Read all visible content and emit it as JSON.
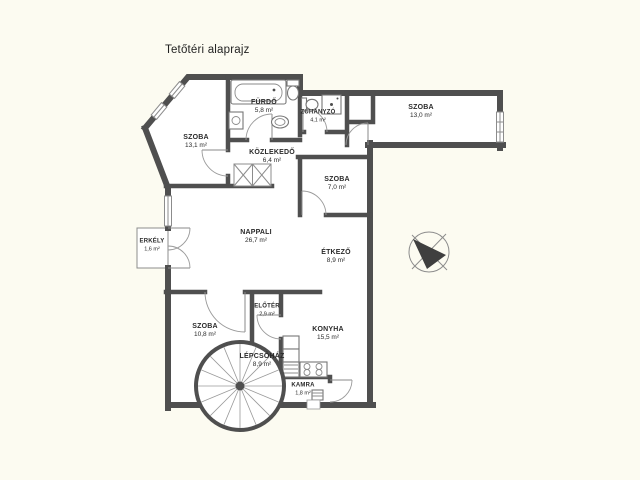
{
  "title": "Tetőtéri alaprajz",
  "rooms": [
    {
      "id": "szoba-131",
      "name": "SZOBA",
      "area": "13,1 m²"
    },
    {
      "id": "furdo",
      "name": "FÜRDŐ",
      "area": "5,8 m²"
    },
    {
      "id": "zuhanyzo",
      "name": "ZUHANYZÓ",
      "area": "4,1 m²"
    },
    {
      "id": "szoba-130",
      "name": "SZOBA",
      "area": "13,0 m²"
    },
    {
      "id": "kozlekedo",
      "name": "KÖZLEKEDŐ",
      "area": "6,4 m²"
    },
    {
      "id": "szoba-70",
      "name": "SZOBA",
      "area": "7,0 m²"
    },
    {
      "id": "erkely",
      "name": "ERKÉLY",
      "area": "1,6 m²"
    },
    {
      "id": "nappali",
      "name": "NAPPALI",
      "area": "26,7 m²"
    },
    {
      "id": "etkezo",
      "name": "ÉTKEZŐ",
      "area": "8,9 m²"
    },
    {
      "id": "szoba-108",
      "name": "SZOBA",
      "area": "10,8 m²"
    },
    {
      "id": "eloter",
      "name": "ELŐTÉR",
      "area": "2,9 m²"
    },
    {
      "id": "lepcsohaz",
      "name": "LÉPCSŐHÁZ",
      "area": "8,9 m²"
    },
    {
      "id": "konyha",
      "name": "KONYHA",
      "area": "15,5 m²"
    },
    {
      "id": "kamra",
      "name": "KAMRA",
      "area": "1,8 m²"
    }
  ],
  "colors": {
    "wall": "#4f4f4f",
    "thin_line": "#8c8c8c",
    "background": "#fcfbf1",
    "floor": "#ffffff",
    "text": "#2a2a2a"
  }
}
